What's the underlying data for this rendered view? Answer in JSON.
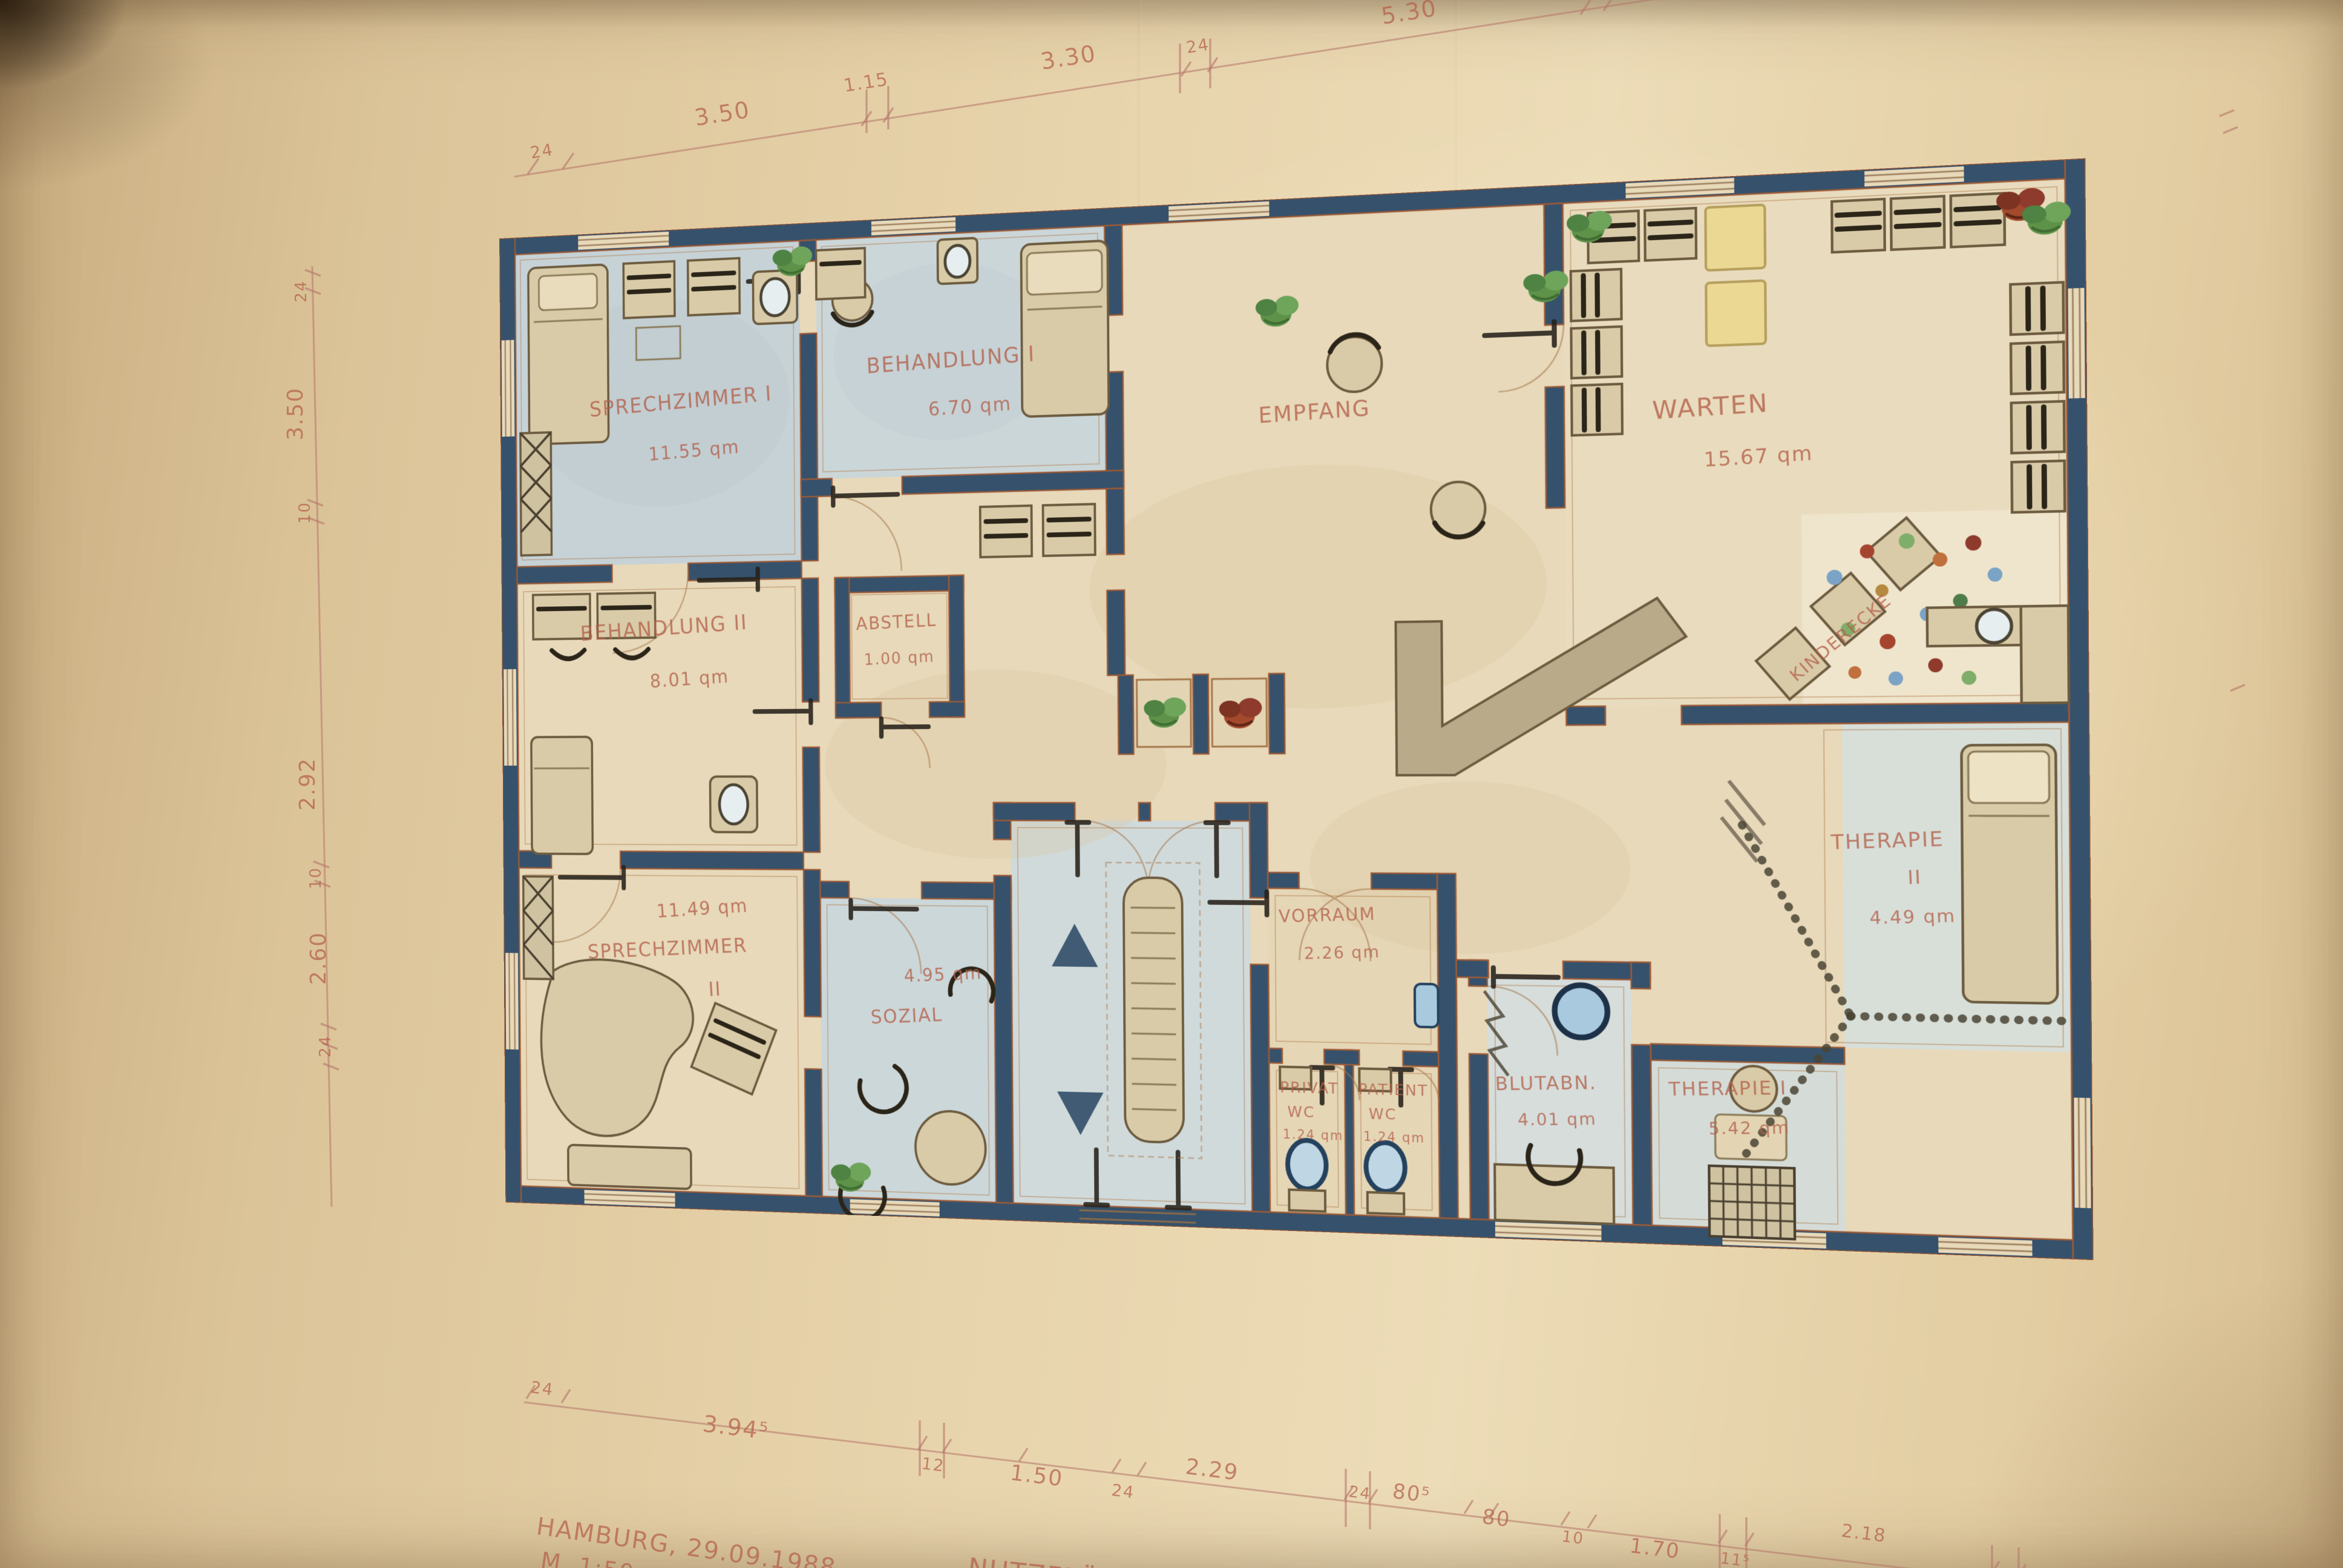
{
  "rooms": {
    "sprechzimmer1": {
      "name": "SPRECHZIMMER I",
      "area": "11.55 qm"
    },
    "behandlung1": {
      "name": "BEHANDLUNG I",
      "area": "6.70 qm"
    },
    "empfang": {
      "name": "EMPFANG"
    },
    "warten": {
      "name": "WARTEN",
      "area": "15.67 qm",
      "corner_note": "KINDERECKE"
    },
    "abstell": {
      "name": "ABSTELL",
      "area": "1.00 qm"
    },
    "behandlung2": {
      "name": "BEHANDLUNG II",
      "area": "8.01 qm"
    },
    "sprechzimmer2": {
      "name": "SPRECHZIMMER",
      "suffix": "II",
      "area": "11.49 qm"
    },
    "sozial": {
      "name": "SOZIAL",
      "area": "4.95 qm"
    },
    "vorraum": {
      "name": "VORRAUM",
      "area": "2.26 qm"
    },
    "wc_privat": {
      "name": "PRIVAT",
      "type": "WC",
      "area": "1.24 qm"
    },
    "wc_patient": {
      "name": "PATIENT",
      "type": "WC",
      "area": "1.24 qm"
    },
    "blutabn": {
      "name": "BLUTABN.",
      "area": "4.01 qm"
    },
    "therapie1": {
      "name": "THERAPIE I",
      "area": "5.42 qm"
    },
    "therapie2": {
      "name": "THERAPIE",
      "suffix": "II",
      "area": "4.49 qm"
    }
  },
  "dimensions": {
    "top": [
      "24",
      "3.50",
      "1.15",
      "3.30",
      "24",
      "5.30"
    ],
    "left": [
      "24",
      "3.50",
      "10",
      "2.92",
      "10",
      "2.60",
      "24"
    ],
    "bottom": [
      "24",
      "3.94⁵",
      "12",
      "1.50",
      "24",
      "2.29",
      "24",
      "80⁵",
      "80",
      "10",
      "1.70",
      "11⁵",
      "2.18"
    ]
  },
  "annotations": {
    "city_date": "HAMBURG, 29.09.1988",
    "scale": "M. 1:50",
    "bottom_note": "NUTZFLÄCHE"
  },
  "colors": {
    "paper": "#e4cfa6",
    "wall": "#35516c",
    "pencil_label": "#b4604a",
    "room_wash_blue": "#cbd6d8",
    "room_wash_cream": "#e7d9ba"
  }
}
